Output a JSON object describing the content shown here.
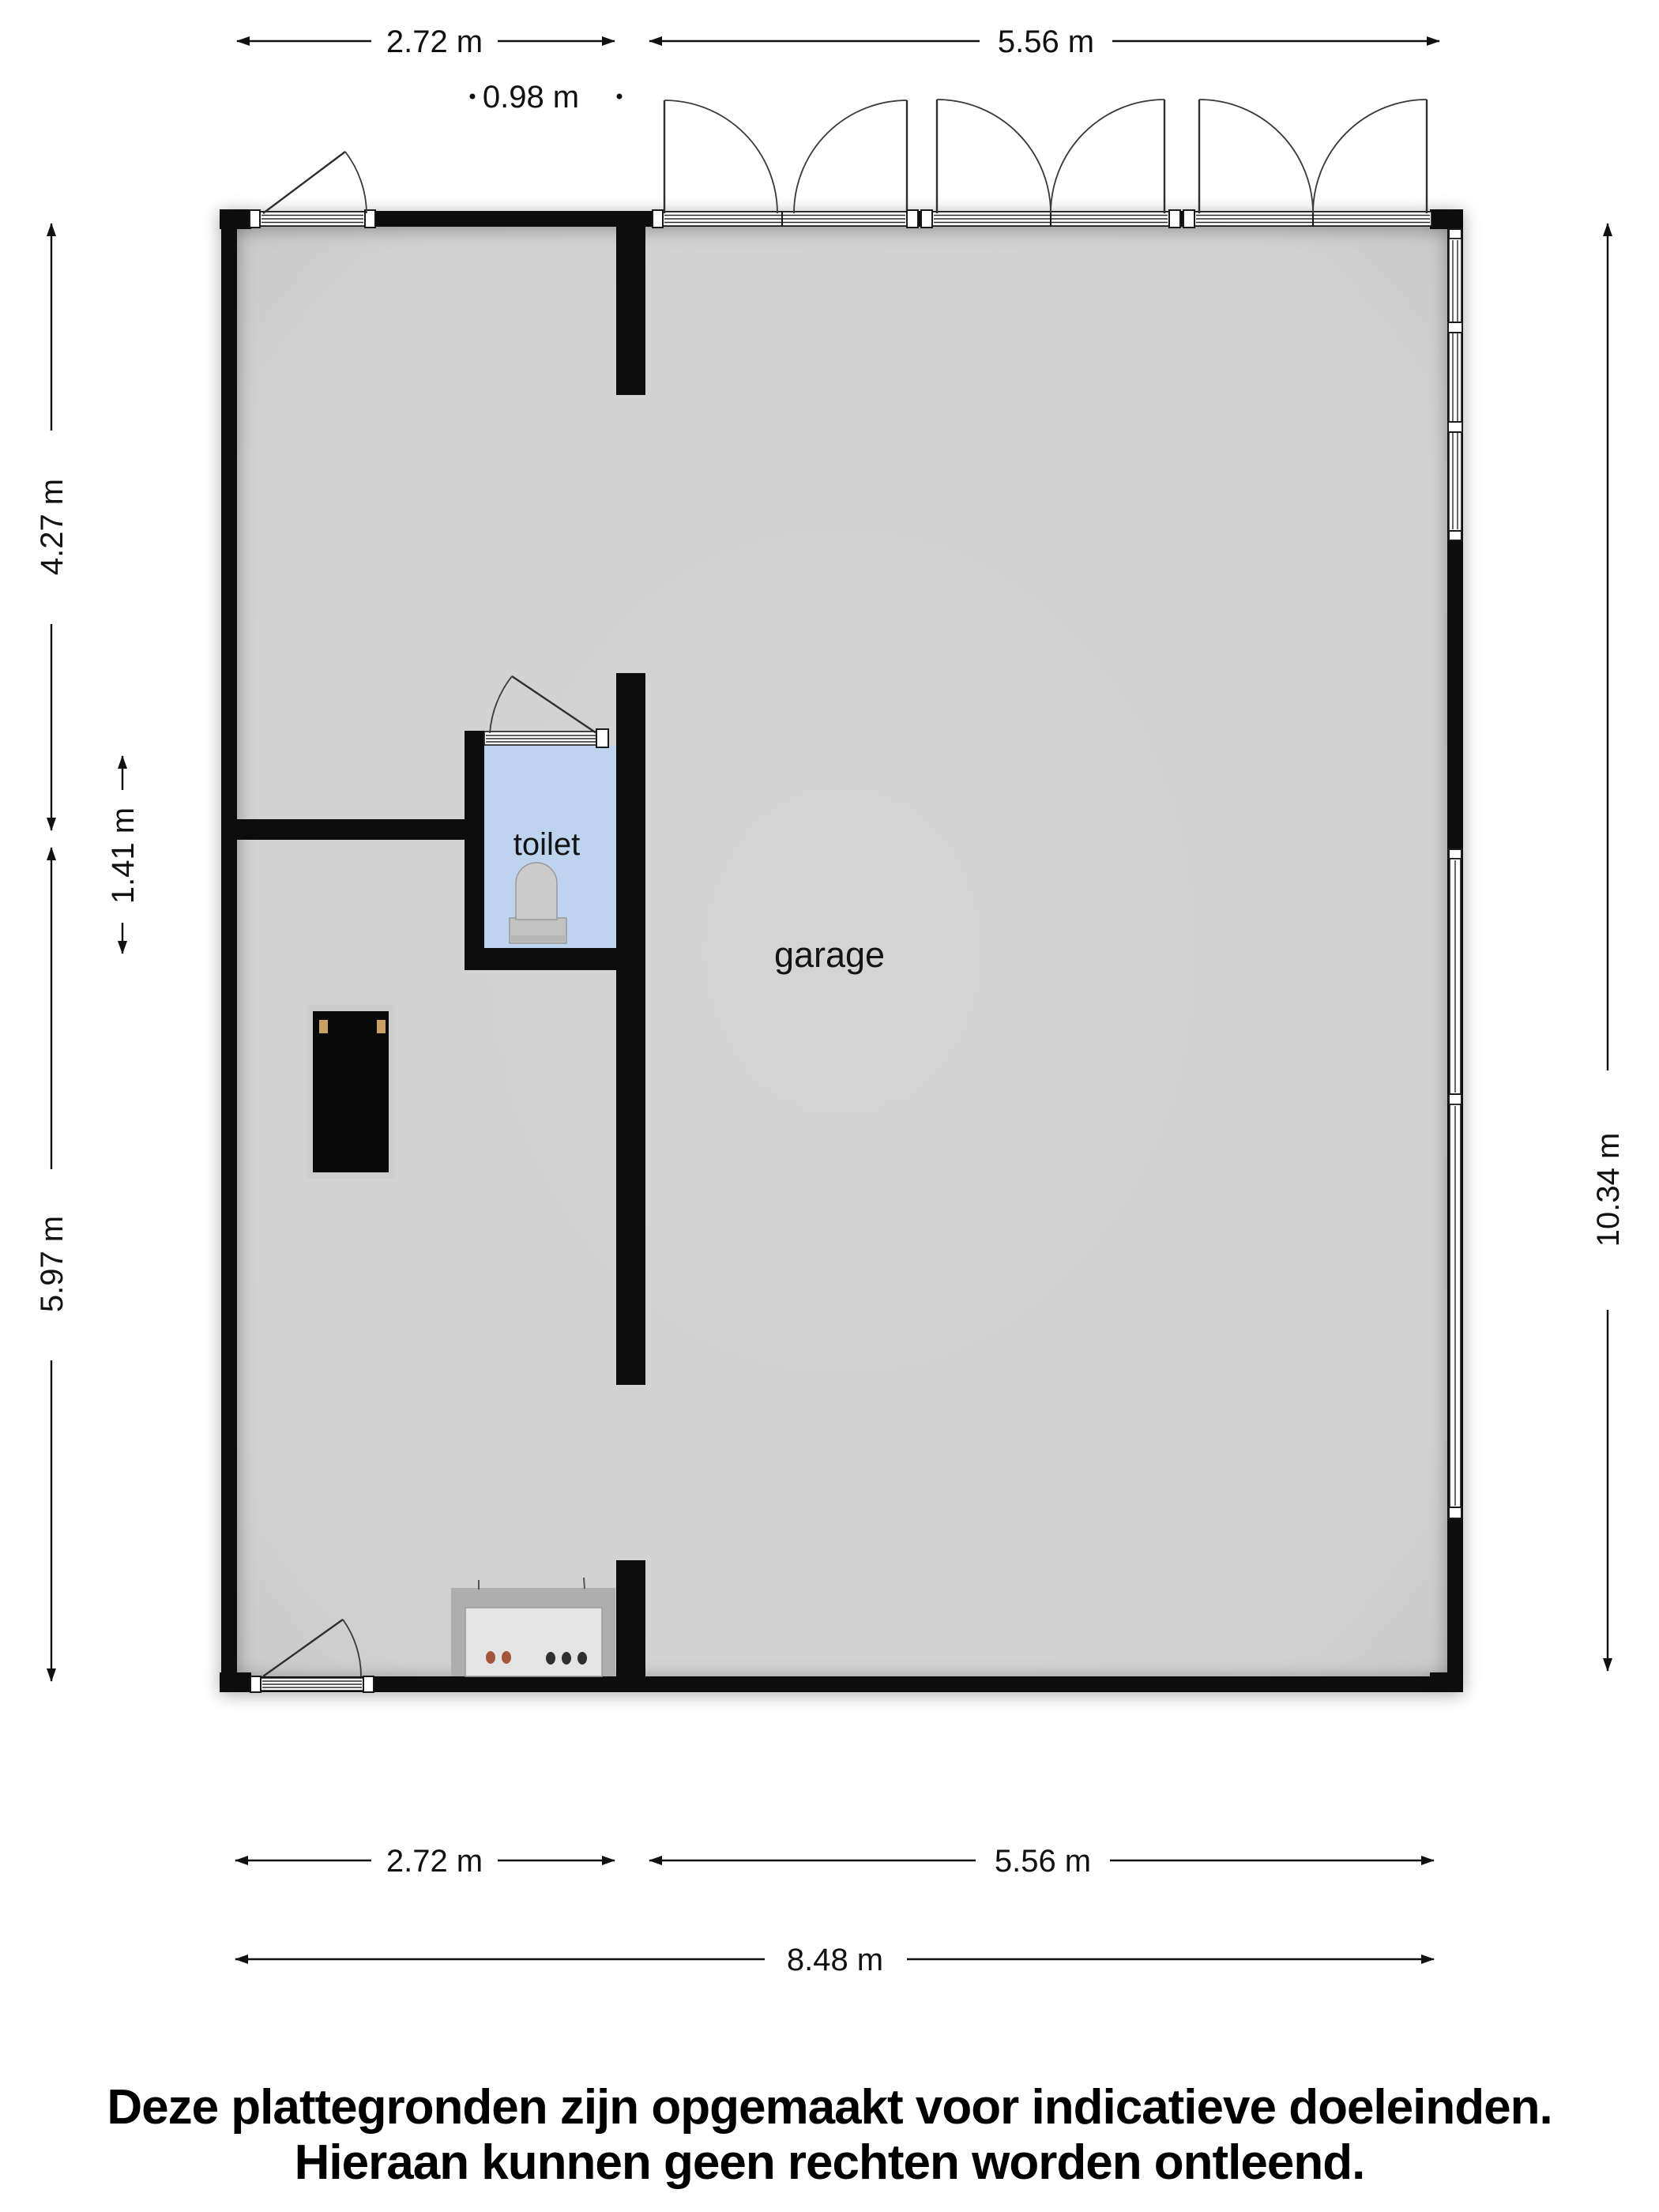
{
  "plan": {
    "room_labels": {
      "garage": "garage",
      "toilet": "toilet"
    },
    "dimensions": {
      "top_left": "2.72 m",
      "top_right": "5.56 m",
      "top_small": "0.98 m",
      "left_upper": "4.27 m",
      "left_mid": "1.41 m",
      "left_lower": "5.97 m",
      "right_total": "10.34 m",
      "bottom_left": "2.72 m",
      "bottom_right": "5.56 m",
      "bottom_total": "8.48 m"
    },
    "colors": {
      "wall": "#0c0c0c",
      "garage_floor": "#d2d2d2",
      "toilet_floor": "#bdd3ee",
      "cabinet_handle": "#c8a264",
      "counter_knob_warm": "#a4563a",
      "counter_knob_dark": "#2f2f2f"
    }
  },
  "disclaimer": {
    "line1": "Deze plattegronden zijn opgemaakt voor indicatieve doeleinden.",
    "line2": "Hieraan kunnen geen rechten worden ontleend."
  }
}
